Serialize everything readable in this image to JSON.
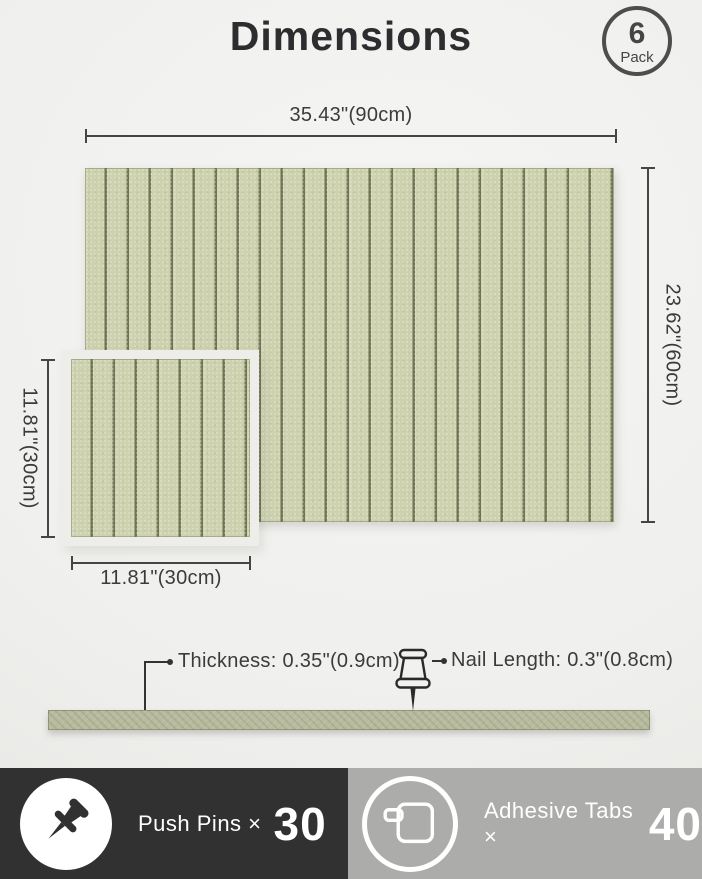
{
  "title": "Dimensions",
  "badge": {
    "count": "6",
    "label": "Pack"
  },
  "panels": {
    "large": {
      "width_label": "35.43\"(90cm)",
      "height_label": "23.62\"(60cm)"
    },
    "small": {
      "height_label": "11.81\"(30cm)",
      "width_label": "11.81\"(30cm)"
    }
  },
  "side_view": {
    "thickness_label": "Thickness: 0.35\"(0.9cm)",
    "nail_label": "Nail Length: 0.3\"(0.8cm)"
  },
  "footer": {
    "push_pins": {
      "label": "Push Pins ×",
      "count": "30",
      "icon": "push-pin-icon"
    },
    "adhesive_tabs": {
      "label": "Adhesive Tabs ×",
      "count": "40",
      "icon": "adhesive-tab-icon"
    }
  },
  "colors": {
    "felt": "#cdd1ae",
    "groove": "#6f7452",
    "strip": "#b9bb9e",
    "footer_dark": "#313132",
    "footer_gray": "#acacab"
  }
}
